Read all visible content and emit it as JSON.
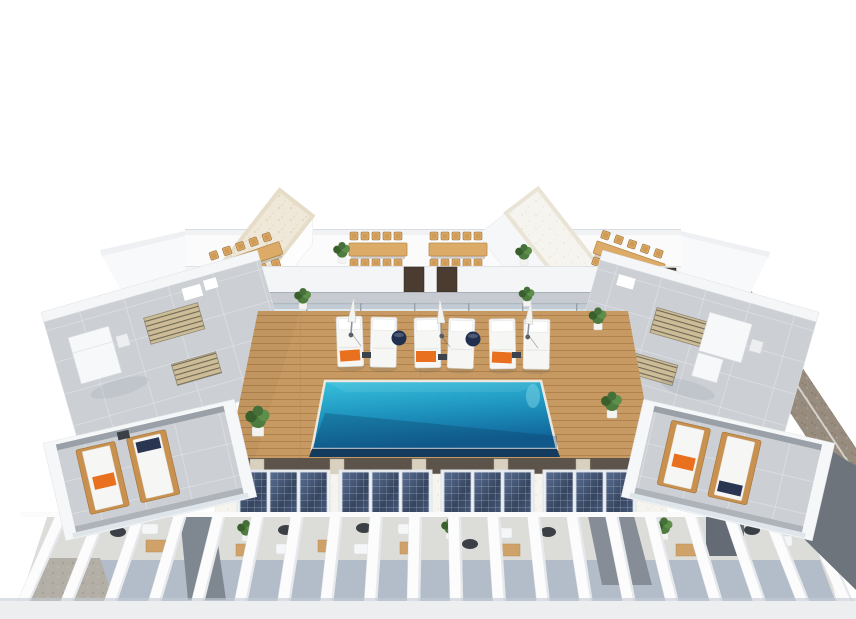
{
  "scene": {
    "title": "Aerial 3D architectural render of a rooftop terrace with swimming pool, sun deck, solar panels and pergolas",
    "setting": "computer-generated visualization on a plain white background",
    "elements": {
      "swimming_pool": 1,
      "wood_deck": 1,
      "stair_towers": 2,
      "dining_sets": 4,
      "deck_sun_loungers": 6,
      "closed_parasols": 3,
      "navy_pouf_tables": 2,
      "wooden_side_loungers": 4,
      "orange_towels": 5,
      "solar_panel_arrays": 4,
      "solar_panels_per_array": 3,
      "pergola_beams": 20,
      "potted_plants": 10,
      "gray_tile_terraces": 2,
      "brown_doors": 3
    }
  },
  "colors": {
    "background": "#ffffff",
    "deck_wood": "#c89a63",
    "deck_wood_line": "#b0814a",
    "pool_top": "#38c2de",
    "pool_mid": "#1d92bd",
    "pool_deep": "#11659a",
    "pool_rim": "#143a5e",
    "tile": "#ccd0d5",
    "wall_white": "#fdfdfe",
    "wall_shade": "#eef0f3",
    "roof_gravel": "#efe8d9",
    "roof_white": "#f6f4ee",
    "solar_light": "#5a6f94",
    "solar_dark": "#36455f",
    "solar_mid": "#46587a",
    "wood_furniture": "#dcab67",
    "wood_frame": "#c9914f",
    "cushion_white": "#f6f6f4",
    "umbrella": "#f4f4f1",
    "pouf": "#223050",
    "orange": "#e8701f",
    "leaf": "#4e7c3f",
    "leaf_dark": "#39602c",
    "leaf_light": "#5d8f4a",
    "door": "#4a3c31",
    "corridor": "#c7cbd1",
    "glass": "#bccdd8",
    "shadow_gap": "#5c544a",
    "pillar": "#d9d0bf",
    "pergola_floor": "#dcdcd9",
    "pergola_shadow": "#b3bdc9",
    "ground_brown": "#978c7e",
    "gravel_gray": "#b3aea6",
    "dark_wedge": "#7f8791",
    "bottom_strip": "#eceef0",
    "beam": "#fcfcfd"
  }
}
